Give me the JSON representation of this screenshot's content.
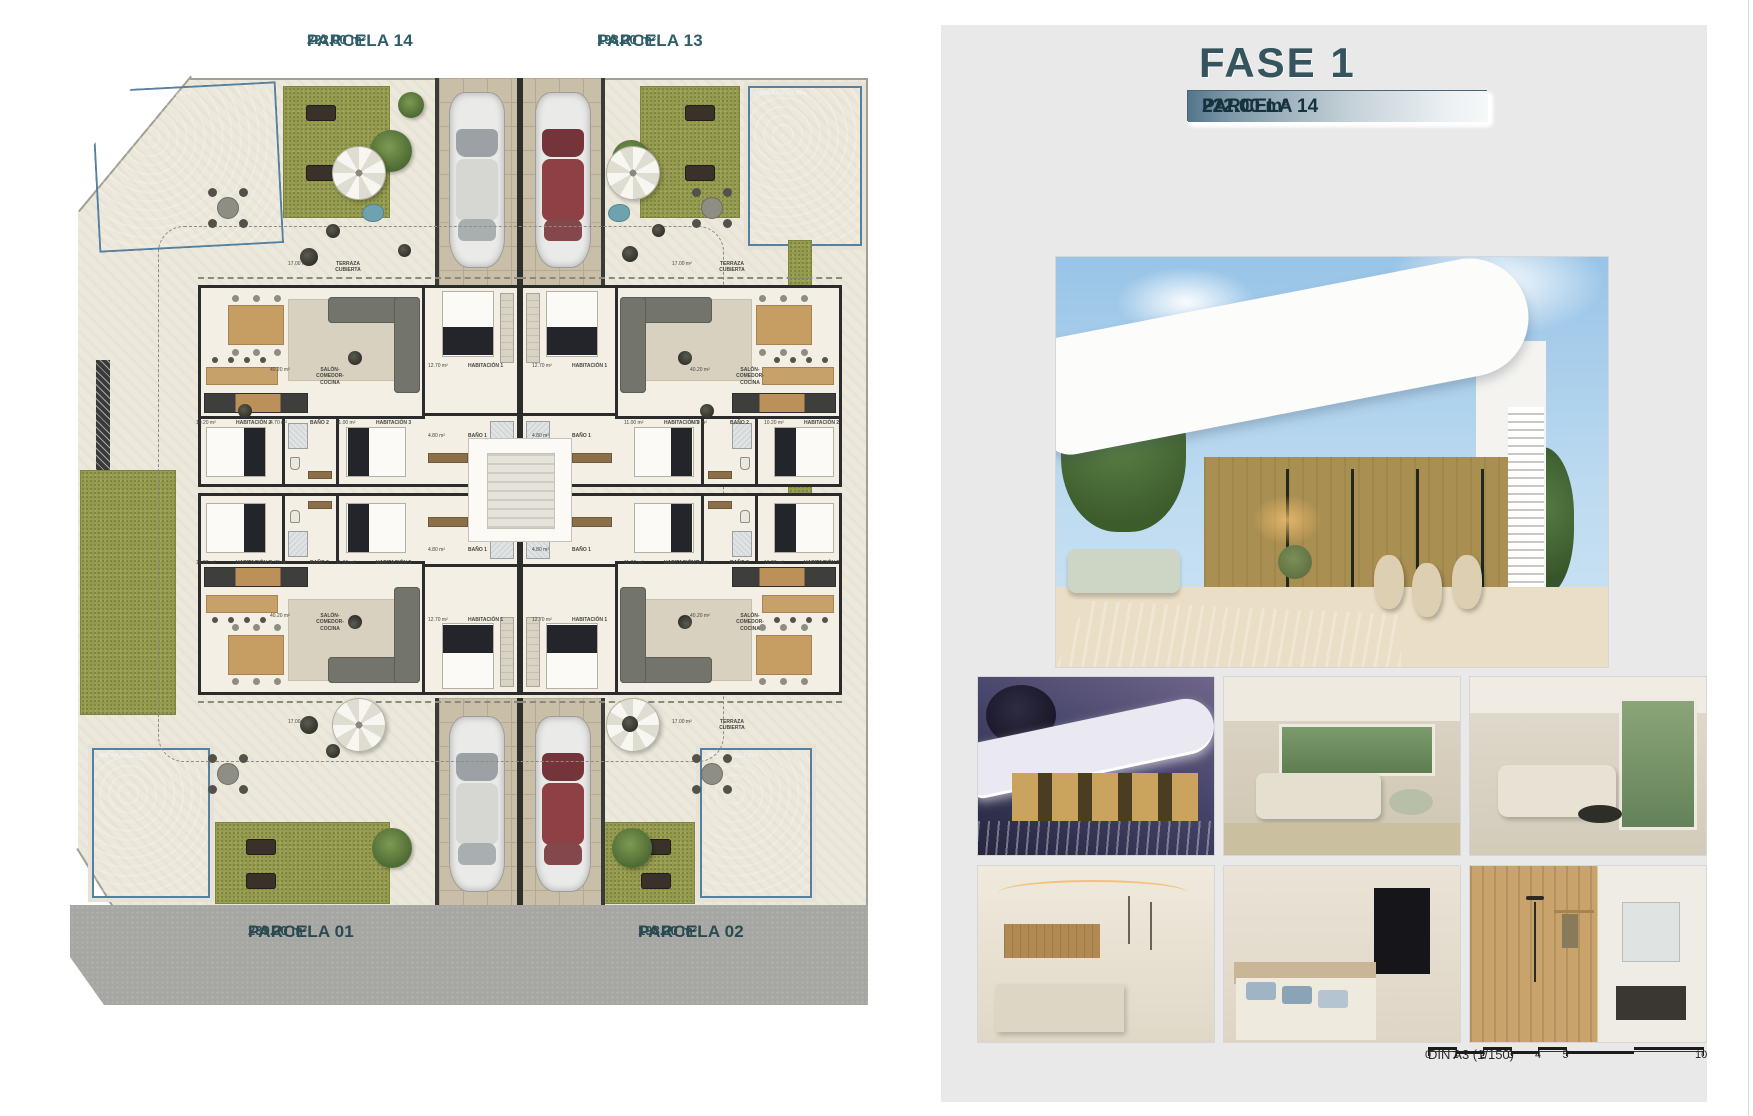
{
  "sheet": {
    "parcels": [
      {
        "label": "PARCELA 14",
        "area": "222.00 m²",
        "position": "top-left"
      },
      {
        "label": "PARCELA 13",
        "area": "198.20 m²",
        "position": "top-right"
      },
      {
        "label": "PARCELA 01",
        "area": "239.20 m²",
        "position": "bottom-left"
      },
      {
        "label": "PARCELA 02",
        "area": "198.20 m²",
        "position": "bottom-right"
      }
    ],
    "pool_label": "PISCINA 4.60 x 2.30 m",
    "rooms": {
      "terraza": {
        "name": "TERRAZA CUBIERTA",
        "area": "17.00 m²"
      },
      "salon": {
        "name": "SALÓN-COMEDOR-COCINA",
        "area": "40.20 m²"
      },
      "hab1": {
        "name": "HABITACIÓN 1",
        "area": "12.70 m²"
      },
      "bano1": {
        "name": "BAÑO 1",
        "area": "4.80 m²"
      },
      "hab2": {
        "name": "HABITACIÓN 2",
        "area": "10.20 m²"
      },
      "bano2": {
        "name": "BAÑO 2",
        "area": "4.70 m²"
      },
      "hab3": {
        "name": "HABITACIÓN 3",
        "area": "11.00 m²"
      }
    }
  },
  "panel": {
    "title": "FASE 1",
    "table": [
      {
        "label": "PARCELA 01",
        "area": "239.20 m²"
      },
      {
        "label": "PARCELA 02",
        "area": "198.20 m²"
      },
      {
        "label": "PARCELA 13",
        "area": "198.20 m²"
      },
      {
        "label": "PARCELA 14",
        "area": "222.00 m²"
      }
    ],
    "photos": {
      "main": "villa-exterior-day-pool",
      "thumbs": [
        "villa-exterior-night-pool",
        "living-room-terrace",
        "living-room-sofa",
        "kitchen-dining",
        "bedroom-tv",
        "bathroom-shower"
      ]
    },
    "scale": {
      "label": "DIN A3 (1/150)",
      "ticks": [
        0,
        1,
        2,
        3,
        4,
        5
      ],
      "end_tick": 10
    }
  },
  "colors": {
    "accent_teal": "#2e5d68",
    "heading": "#35545e",
    "row_text": "#16323e",
    "panel_bg": "#e9e9e9",
    "pool": "#7aa9cc",
    "grass": "#949a4e",
    "road": "#a6a6a2"
  }
}
